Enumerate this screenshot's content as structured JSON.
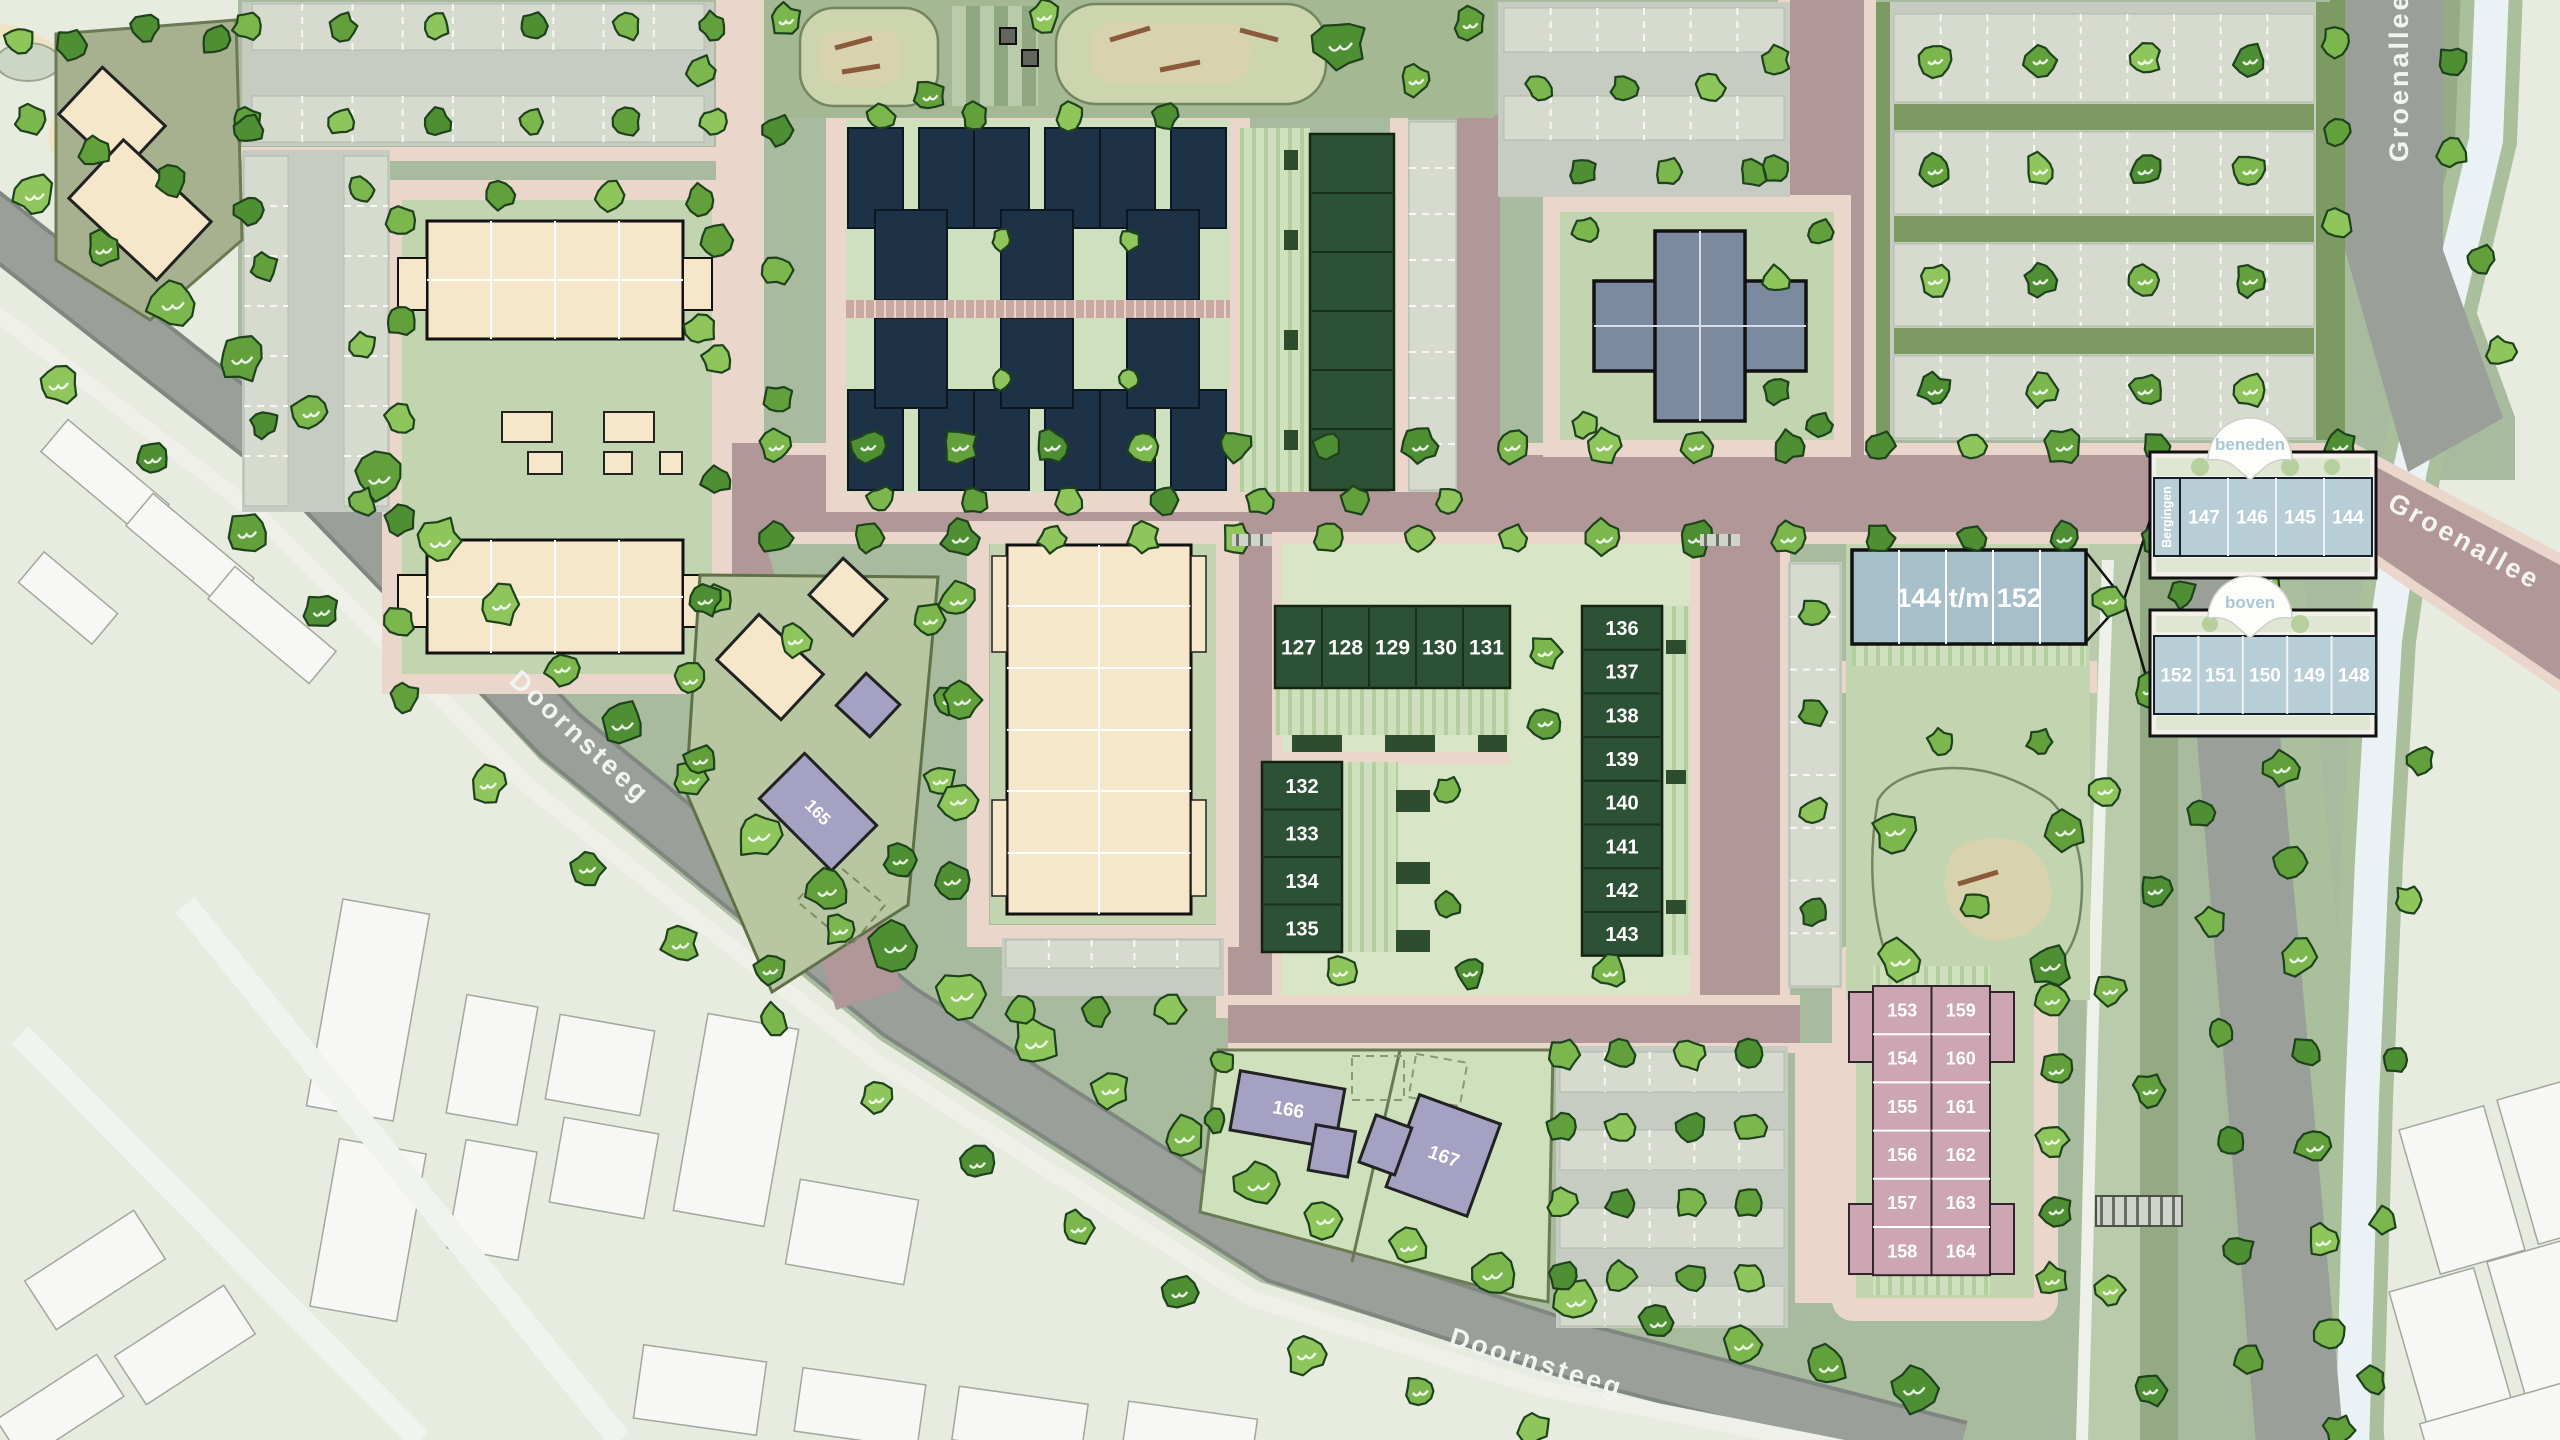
{
  "streets": {
    "doornsteeg_w": "Doornsteeg",
    "doornsteeg_s": "Doornsteeg",
    "groenallee_n": "Groenallee",
    "groenallee_e": "Groenallee"
  },
  "callouts": {
    "beneden": "beneden",
    "boven": "boven",
    "bergingen": "Bergingen",
    "beneden_units": [
      "147",
      "146",
      "145",
      "144"
    ],
    "boven_units": [
      "152",
      "151",
      "150",
      "149",
      "148"
    ]
  },
  "buildings": {
    "apartment_range": "144 t/m 152",
    "villa_165": "165",
    "villa_166": "166",
    "villa_167": "167"
  },
  "plots": {
    "row_north": [
      "127",
      "128",
      "129",
      "130",
      "131"
    ],
    "col_west": [
      "132",
      "133",
      "134",
      "135"
    ],
    "col_east": [
      "136",
      "137",
      "138",
      "139",
      "140",
      "141",
      "142",
      "143"
    ],
    "pink_west": [
      "153",
      "154",
      "155",
      "156",
      "157",
      "158"
    ],
    "pink_east": [
      "159",
      "160",
      "161",
      "162",
      "163",
      "164"
    ]
  },
  "colors": {
    "road_main": "#b29799",
    "road_grey": "#9aa099",
    "path": "#ead6cb",
    "ground": "#a9bb9e",
    "garden": "#cfe0bf",
    "roof_navy": "#1e3247",
    "roof_green": "#2c5134",
    "building_cream": "#f6e7ca",
    "building_blue": "#a6bfca",
    "building_pink": "#cda6b4",
    "building_purple": "#a5a1c2",
    "building_grey": "#7c8aa0",
    "water": "#ebf2f6",
    "faded": "#e7ebe0",
    "callout_text": "#a9c7d5",
    "tree_dark": "#4f8f33",
    "tree_light": "#8fc65c"
  }
}
